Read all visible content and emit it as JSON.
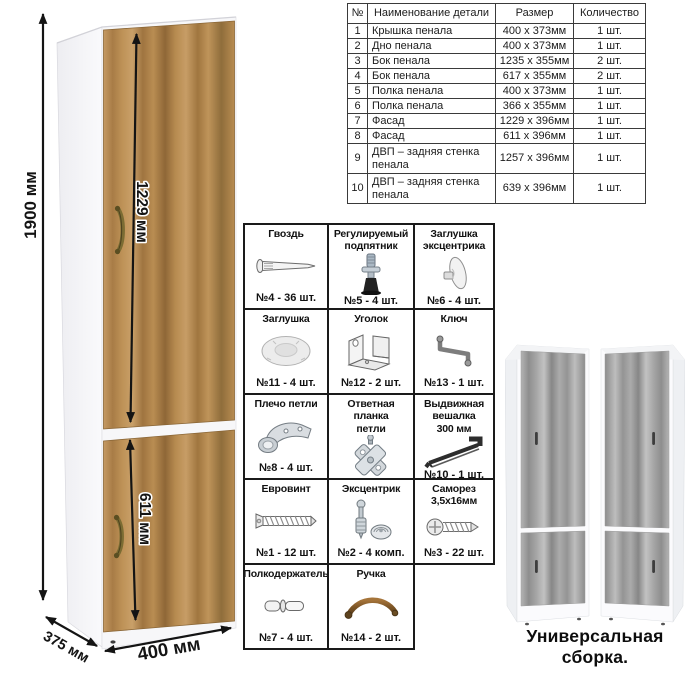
{
  "cabinet": {
    "dims": {
      "height": "1900 мм",
      "facade_upper": "1229 мм",
      "facade_lower": "611 мм",
      "depth": "375 мм",
      "width": "400 мм"
    }
  },
  "parts_table": {
    "headers": [
      "№",
      "Наименование детали",
      "Размер",
      "Количество"
    ],
    "rows": [
      {
        "num": "1",
        "name": "Крышка пенала",
        "size": "400 x 373мм",
        "qty": "1 шт."
      },
      {
        "num": "2",
        "name": "Дно пенала",
        "size": "400 x 373мм",
        "qty": "1 шт."
      },
      {
        "num": "3",
        "name": "Бок пенала",
        "size": "1235 x 355мм",
        "qty": "2 шт."
      },
      {
        "num": "4",
        "name": "Бок пенала",
        "size": "617 x 355мм",
        "qty": "2 шт."
      },
      {
        "num": "5",
        "name": "Полка пенала",
        "size": "400 x 373мм",
        "qty": "1 шт."
      },
      {
        "num": "6",
        "name": "Полка пенала",
        "size": "366 x 355мм",
        "qty": "1 шт."
      },
      {
        "num": "7",
        "name": "Фасад",
        "size": "1229 x 396мм",
        "qty": "1 шт."
      },
      {
        "num": "8",
        "name": "Фасад",
        "size": "611 x 396мм",
        "qty": "1 шт."
      },
      {
        "num": "9",
        "name": "ДВП – задняя стенка пенала",
        "size": "1257 x 396мм",
        "qty": "1 шт."
      },
      {
        "num": "10",
        "name": "ДВП – задняя стенка пенала",
        "size": "639 x 396мм",
        "qty": "1 шт."
      }
    ]
  },
  "hardware": {
    "items": [
      {
        "title": "Гвоздь",
        "count": "№4 - 36 шт.",
        "icon": "nail-icon"
      },
      {
        "title": "Регулируемый\nподпятник",
        "count": "№5 - 4 шт.",
        "icon": "adjustable-foot-icon"
      },
      {
        "title": "Заглушка\nэксцентрика",
        "count": "№6 - 4 шт.",
        "icon": "cam-cap-icon"
      },
      {
        "title": "Заглушка",
        "count": "№11 - 4 шт.",
        "icon": "cap-icon"
      },
      {
        "title": "Уголок",
        "count": "№12 - 2 шт.",
        "icon": "corner-bracket-icon"
      },
      {
        "title": "Ключ",
        "count": "№13 - 1 шт.",
        "icon": "hex-key-icon"
      },
      {
        "title": "Плечо петли",
        "count": "№8 - 4 шт.",
        "icon": "hinge-arm-icon"
      },
      {
        "title": "Ответная планка\nпетли",
        "count": "№9 - 4 шт.",
        "icon": "hinge-plate-icon"
      },
      {
        "title": "Выдвижная\nвешалка\n300 мм",
        "count": "№10 - 1 шт.",
        "icon": "pullout-hanger-icon"
      },
      {
        "title": "Евровинт",
        "count": "№1 - 12 шт.",
        "icon": "euroscrew-icon"
      },
      {
        "title": "Эксцентрик",
        "count": "№2 - 4 комп.",
        "icon": "eccentric-icon"
      },
      {
        "title": "Саморез\n3,5x16мм",
        "count": "№3 - 22 шт.",
        "icon": "selftapping-screw-icon"
      },
      {
        "title": "Полкодержатель",
        "count": "№7 - 4 шт.",
        "icon": "shelf-pin-icon"
      },
      {
        "title": "Ручка",
        "count": "№14 - 2 шт.",
        "icon": "handle-icon"
      }
    ]
  },
  "variants": {
    "caption": "Универсальная сборка."
  },
  "colors": {
    "wood": "#b98e55",
    "wood_dark": "#8f6737",
    "gray_wood": "#9a9a9a",
    "handle_bronze": "#7b6c33",
    "line": "#141414"
  }
}
